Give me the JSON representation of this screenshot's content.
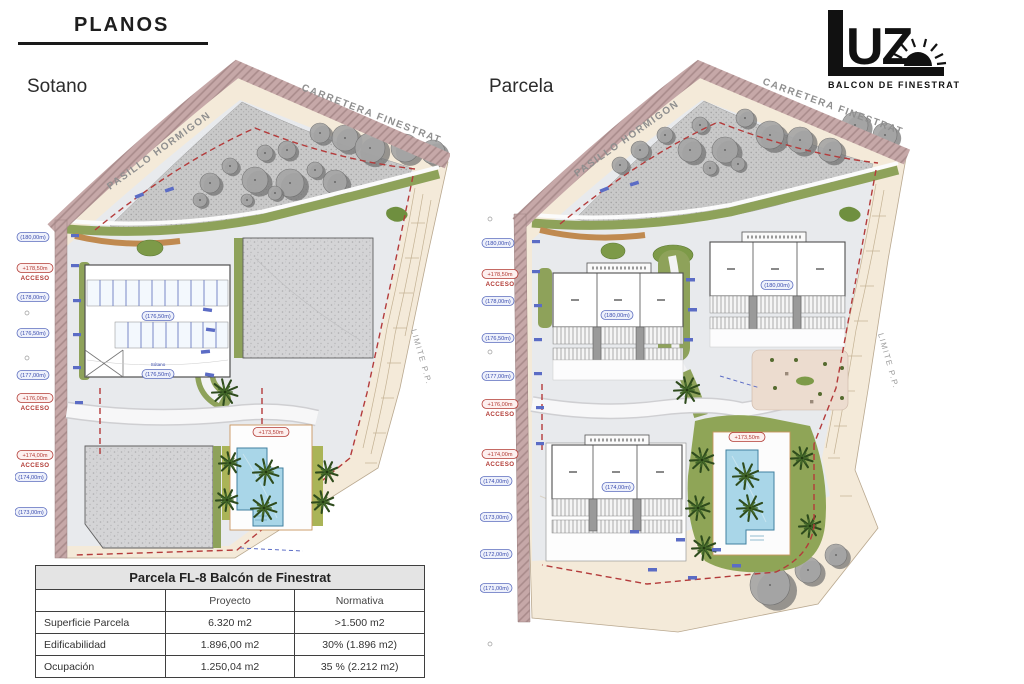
{
  "header": {
    "title": "PLANOS",
    "logo": {
      "uz": "UZ",
      "subtitle": "BALCON DE FINESTRAT"
    }
  },
  "plans": {
    "left": {
      "title": "Sotano",
      "road_label": "CARRETERA FINESTRAT",
      "walkway_label": "PASILLO HORMIGON",
      "limit_label": "LIMITE P.P.",
      "levels": [
        "(180,00m)",
        "(178,00m)",
        "(176,50m)",
        "(177,00m)",
        "(174,00m)",
        "(173,00m)"
      ],
      "access": [
        {
          "elev": "+178,50m",
          "label": "ACCESO"
        },
        {
          "elev": "+176,00m",
          "label": "ACCESO"
        },
        {
          "elev": "+174,00m",
          "label": "ACCESO"
        }
      ],
      "interior": {
        "garage_level": "(176,50m)",
        "garage_name": "Sótano",
        "garage_level2": "(176,50m)",
        "pool_level": "+173,50m"
      }
    },
    "right": {
      "title": "Parcela",
      "road_label": "CARRETERA FINESTRAT",
      "walkway_label": "PASILLO HORMIGON",
      "limit_label": "LIMITE P.P.",
      "levels": [
        "(180,00m)",
        "(178,00m)",
        "(176,50m)",
        "(177,00m)",
        "(174,00m)",
        "(173,00m)",
        "(172,00m)",
        "(171,00m)"
      ],
      "access": [
        {
          "elev": "+178,50m",
          "label": "ACCESO"
        },
        {
          "elev": "+176,00m",
          "label": "ACCESO"
        },
        {
          "elev": "+174,00m",
          "label": "ACCESO"
        }
      ],
      "interior": {
        "block_a_level": "(180,00m)",
        "block_b_level": "(180,00m)",
        "block_c_level": "(174,00m)",
        "pool_level": "+173,50m"
      }
    }
  },
  "table": {
    "title": "Parcela FL-8 Balcón de Finestrat",
    "columns": [
      "",
      "Proyecto",
      "Normativa"
    ],
    "rows": [
      {
        "label": "Superficie Parcela",
        "proyecto": "6.320 m2",
        "normativa": ">1.500 m2"
      },
      {
        "label": "Edificabilidad",
        "proyecto": "1.896,00 m2",
        "normativa": "30% (1.896 m2)"
      },
      {
        "label": "Ocupación",
        "proyecto": "1.250,04 m2",
        "normativa": "35 % (2.212 m2)"
      }
    ]
  },
  "colors": {
    "road_band": "#c6a8a8",
    "green": "#8ea25a",
    "pool": "#a9d6e8",
    "boundary_red": "#b43b3b",
    "label_blue": "#3a4cae"
  }
}
